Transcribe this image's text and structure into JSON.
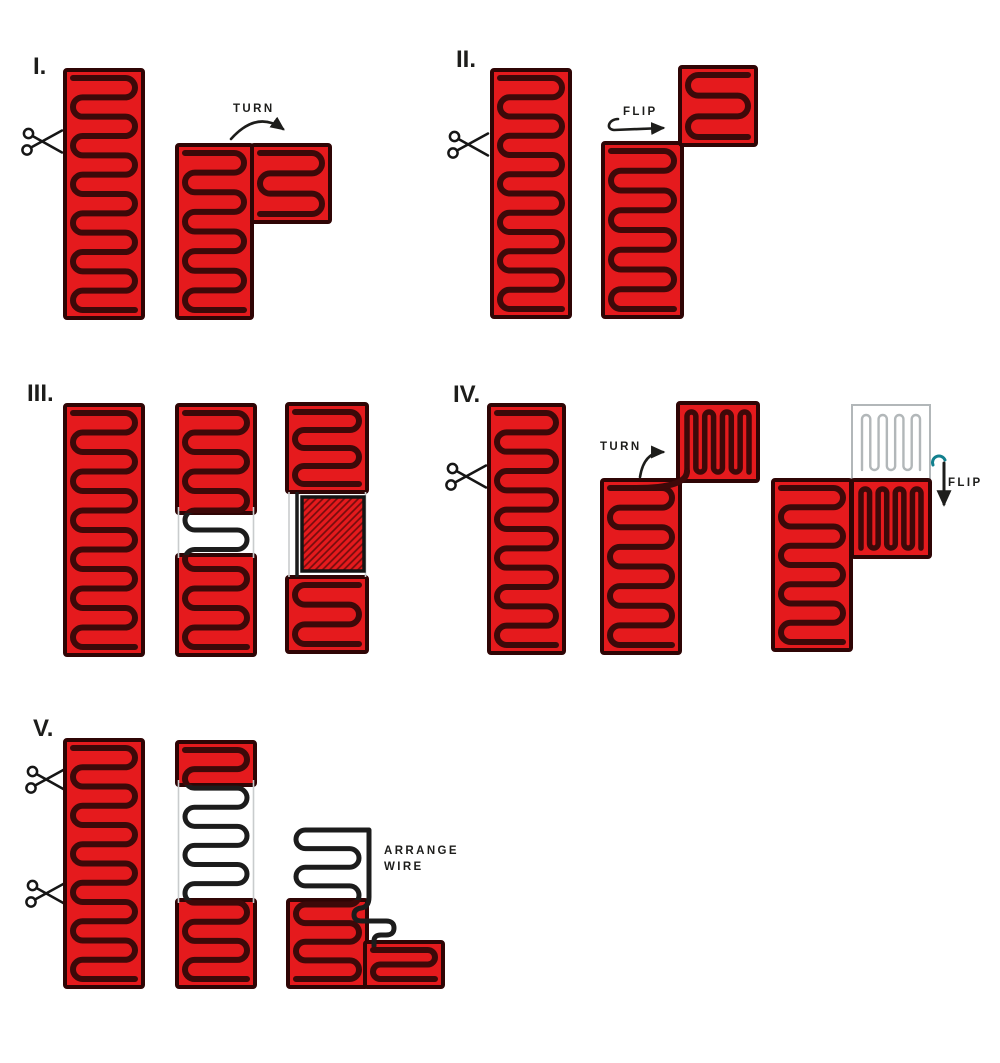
{
  "steps": {
    "s1": {
      "numeral": "I.",
      "turn_label": "TURN"
    },
    "s2": {
      "numeral": "II.",
      "flip_label": "FLIP"
    },
    "s3": {
      "numeral": "III."
    },
    "s4": {
      "numeral": "IV.",
      "turn_label": "TURN",
      "flip_label": "FLIP"
    },
    "s5": {
      "numeral": "V.",
      "arrange_label_line1": "ARRANGE",
      "arrange_label_line2": "WIRE"
    }
  },
  "icons": {
    "scissors": "scissors-icon"
  },
  "colors": {
    "background": "#ffffff",
    "panel_red": "#e51a1d",
    "panel_border": "#2f0505",
    "wire_dark": "#3d0909",
    "wire_black": "#1c1c1c",
    "ghost_gray": "#b2b7b9",
    "substrate_gray": "#c9cccd",
    "flip_hook_teal": "#12808e",
    "text": "#1d1d1b"
  }
}
